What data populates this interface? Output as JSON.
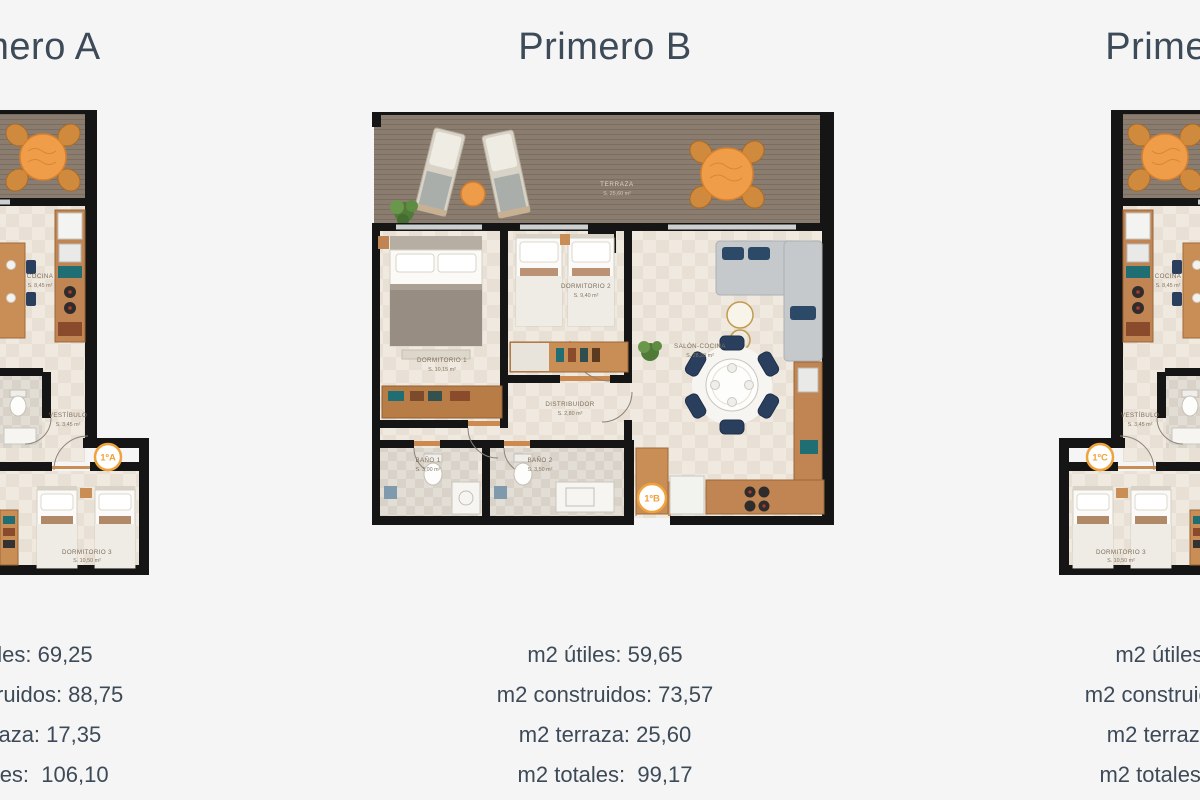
{
  "page": {
    "background": "#f5f5f6",
    "title_color": "#3d4a57",
    "accent_orange": "#f0a23c",
    "wall_color": "#151515",
    "deck_color": "#8a7c6e",
    "floor_color": "#efe9e0",
    "wood_color": "#c98e55"
  },
  "cards": [
    {
      "id": "primero-a",
      "title": "Primero A",
      "badge": "1ºA",
      "stats": [
        "m2 útiles: 69,25",
        "m2 construidos: 88,75",
        "m2 terraza: 17,35",
        "m2 totales:  106,10"
      ],
      "rooms": {
        "terraza": "TERRAZA",
        "terraza_area": "S. 17,35 m²",
        "cocina": "COCINA",
        "cocina_area": "S. 8,45 m²",
        "vestibulo": "VESTÍBULO",
        "vestibulo_area": "S. 3,45 m²",
        "dormitorio": "DORMITORIO 3",
        "dormitorio_area": "S. 10,50 m²"
      }
    },
    {
      "id": "primero-b",
      "title": "Primero B",
      "badge": "1ºB",
      "stats": [
        "m2 útiles: 59,65",
        "m2 construidos: 73,57",
        "m2 terraza: 25,60",
        "m2 totales:  99,17"
      ],
      "rooms": {
        "terraza": "TERRAZA",
        "terraza_area": "S. 25,60 m²",
        "dormitorio1": "DORMITORIO 1",
        "dormitorio1_area": "S. 10,15 m²",
        "dormitorio2": "DORMITORIO 2",
        "dormitorio2_area": "S. 9,40 m²",
        "distribuidor": "DISTRIBUIDOR",
        "distribuidor_area": "S. 2,80 m²",
        "bano1": "BAÑO 1",
        "bano1_area": "S. 3,00 m²",
        "bano2": "BAÑO 2",
        "bano2_area": "S. 3,50 m²",
        "salon": "SALÓN-COCINA",
        "salon_area": "S. 28,20 m²"
      }
    },
    {
      "id": "primero-c",
      "title": "Primero C",
      "badge": "1ºC",
      "stats": [
        "m2 útiles: 69,25",
        "m2 construidos: 88,75",
        "m2 terraza: 17,35",
        "m2 totales:  106,10"
      ],
      "rooms": {
        "terraza": "TERRAZA",
        "terraza_area": "S. 17,35 m²",
        "cocina": "COCINA",
        "cocina_area": "S. 8,45 m²",
        "vestibulo": "VESTÍBULO",
        "vestibulo_area": "S. 3,45 m²",
        "dormitorio": "DORMITORIO 3",
        "dormitorio_area": "S. 10,50 m²"
      }
    }
  ]
}
